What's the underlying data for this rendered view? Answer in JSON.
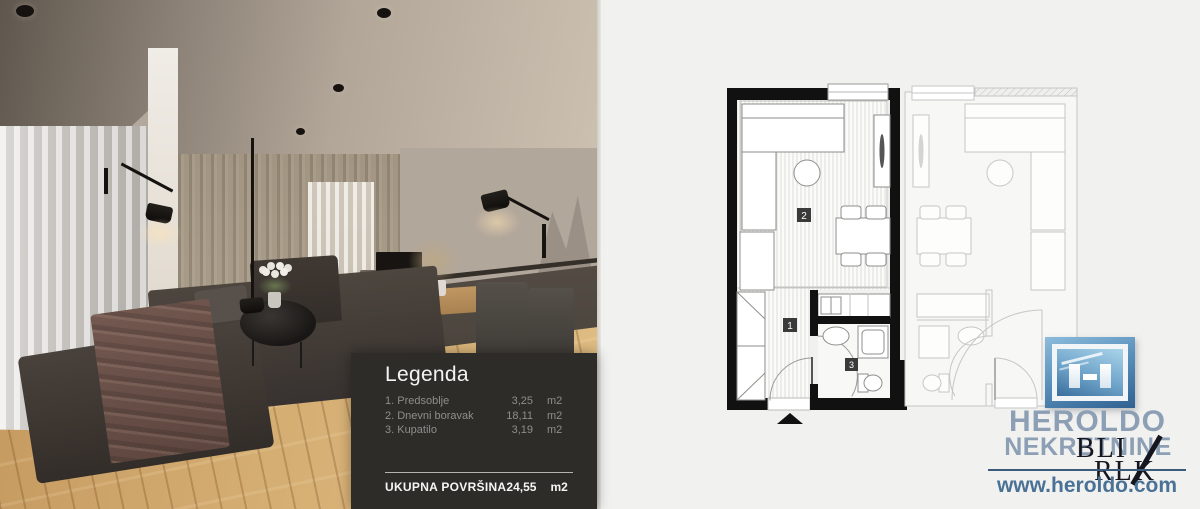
{
  "legend": {
    "title": "Legenda",
    "items": [
      {
        "name": "1. Predsoblje",
        "value": "3,25",
        "unit": "m2"
      },
      {
        "name": "2. Dnevni boravak",
        "value": "18,11",
        "unit": "m2"
      },
      {
        "name": "3. Kupatilo",
        "value": "3,19",
        "unit": "m2"
      }
    ],
    "total": {
      "label": "UKUPNA POVRŠINA",
      "value": "24,55",
      "unit": "m2"
    }
  },
  "floorplan": {
    "labels": {
      "hallway": "1",
      "living_room": "2",
      "bathroom": "3"
    }
  },
  "branding": {
    "name_line1": "HEROLDO",
    "name_line2": "NEKRETNINE",
    "website": "www.heroldo.com",
    "watermark_line1": "BLI",
    "watermark_line2": "RLK"
  },
  "colors": {
    "canvas_bg": "#f1f1ef",
    "legend_bg": "#2e2c29",
    "plan_wall": "#111111",
    "adjacent_unit_stroke": "#c6c6c4",
    "brand_text": "#8d9fb5",
    "brand_link": "#4a7196",
    "logo_blue": "#3a6f9f"
  }
}
